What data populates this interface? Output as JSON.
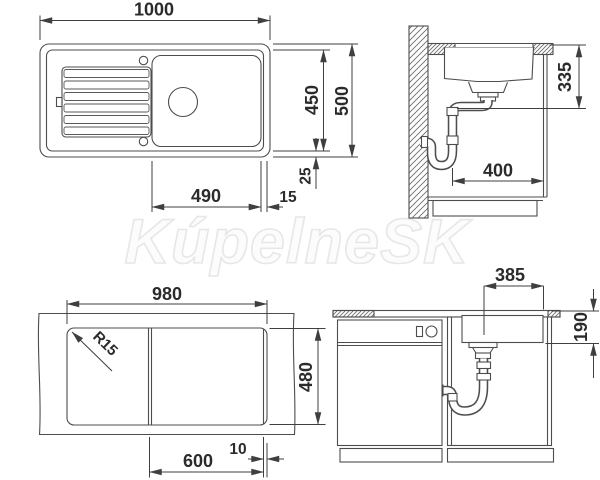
{
  "watermark": "KúpelneSK",
  "colors": {
    "background": "#ffffff",
    "line": "#4d4d4d",
    "dimension_line": "#3f3f3f",
    "dimension_text": "#2b2b2b",
    "watermark_outline": "#e7e7e7",
    "hatch": "#6e6e6e"
  },
  "views": {
    "top": {
      "dims": {
        "overall_width": "1000",
        "inner_depth": "450",
        "overall_depth": "500",
        "rim": "25",
        "basin_width": "490",
        "basin_edge_gap": "15"
      }
    },
    "side": {
      "dims": {
        "drain_depth": "335",
        "drain_offset": "400"
      }
    },
    "cutout": {
      "dims": {
        "cutout_width": "980",
        "corner_radius": "R15",
        "cutout_depth": "480",
        "basin_cutout_width": "600",
        "edge_gap": "10"
      }
    },
    "front": {
      "dims": {
        "basin_width": "385",
        "basin_depth": "190"
      }
    }
  }
}
